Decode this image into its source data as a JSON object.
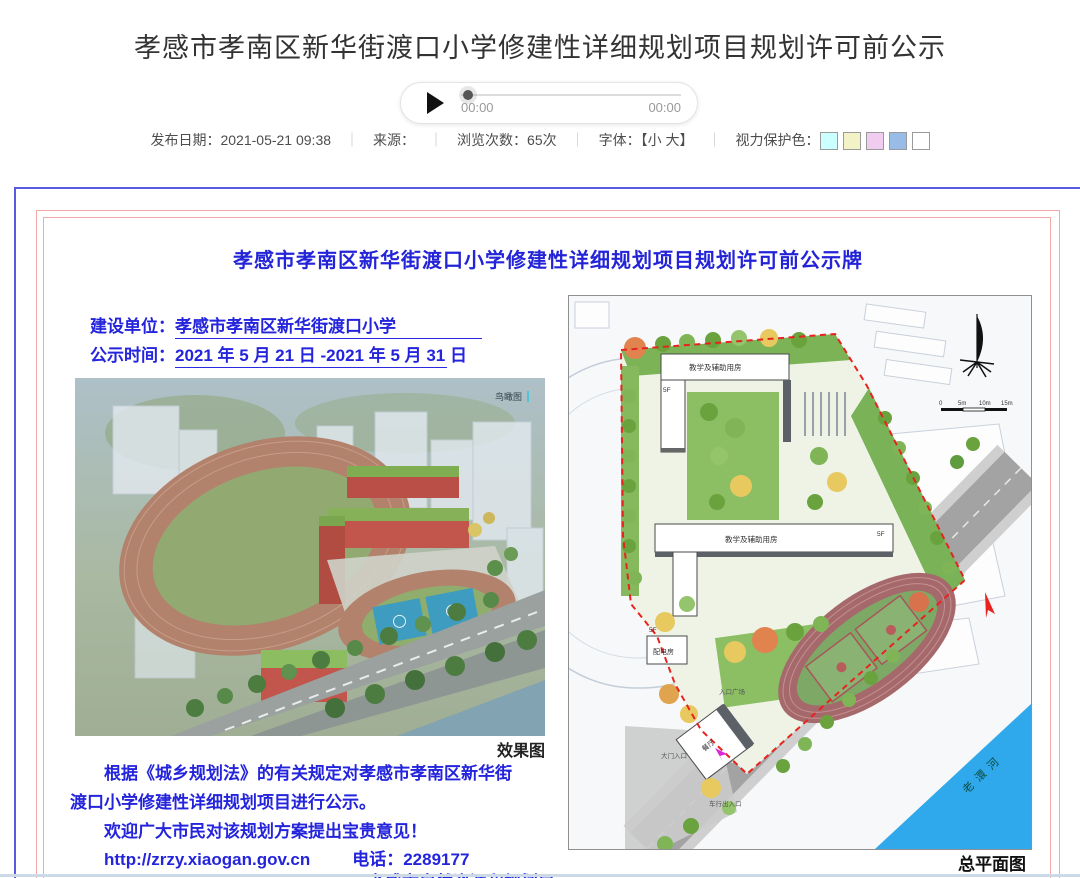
{
  "page": {
    "title": "孝感市孝南区新华街渡口小学修建性详细规划项目规划许可前公示",
    "audio": {
      "current_time": "00:00",
      "total_time": "00:00"
    },
    "meta": {
      "publish_date_label": "发布日期：",
      "publish_date": "2021-05-21 09:38",
      "separator": "｜",
      "source_label": "来源：",
      "views_label": "浏览次数：",
      "views": "65次",
      "font_label": "字体：",
      "bracket_open": "【",
      "font_small": "小",
      "font_large": "大",
      "bracket_close": "】",
      "eye_protect_label": "视力保护色：",
      "eye_colors": [
        "#CCFFFF",
        "#F2F2C6",
        "#F0CCF0",
        "#99BBE8",
        "#FFFFFF"
      ]
    }
  },
  "board": {
    "title": "孝感市孝南区新华街渡口小学修建性详细规划项目规划许可前公示牌",
    "builder_label": "建设单位：",
    "builder_value": "孝感市孝南区新华街渡口小学",
    "period_label": "公示时间：",
    "period_value": "2021 年 5 月 21 日 -2021 年 5 月 31 日",
    "render_tag": "鸟瞰图",
    "render_caption": "效果图",
    "plan_caption": "总平面图",
    "notice_line1": "根据《城乡规划法》的有关规定对孝感市孝南区新华街",
    "notice_line2": "渡口小学修建性详细规划项目进行公示。",
    "notice_line3": "欢迎广大市民对该规划方案提出宝贵意见！",
    "website": "http://zrzy.xiaogan.gov.cn",
    "phone_label": "电话：",
    "phone": "2289177",
    "agency": "孝感市自然资源和规划局"
  },
  "site_plan": {
    "building_label": "教学及辅助用房",
    "building_label2": "教学及辅助用房",
    "power_room": "配电房",
    "canteen": "餐厅",
    "entrance_plaza": "入口广场",
    "vehicle_entrance": "车行出入口",
    "gate_entrance": "大门入口",
    "road_name": "沿河北路",
    "river_name": "老澴河",
    "floor_tag": "5F",
    "scale_labels": [
      "0",
      "5m",
      "10m",
      "15m"
    ]
  },
  "colors": {
    "board_border_blue": "#5a5ae0",
    "board_border_pink": "#f6a9a9",
    "board_text_blue": "#2424dc",
    "boundary_red": "#e8231f",
    "river_blue": "#2fa8ec"
  }
}
